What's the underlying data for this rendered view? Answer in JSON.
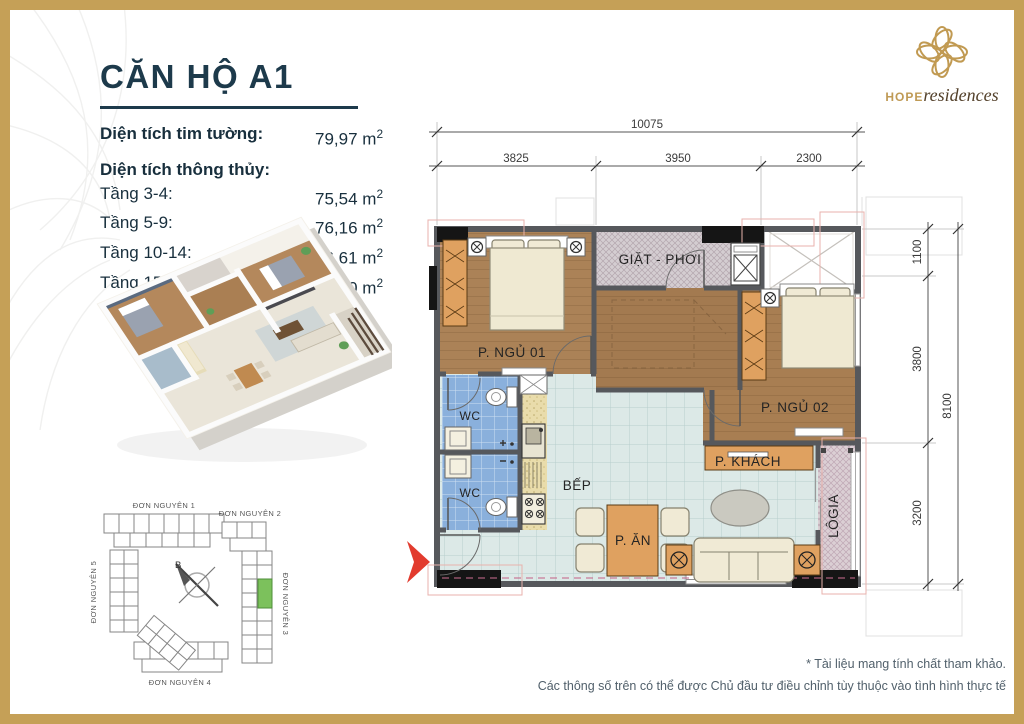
{
  "title": "CĂN HỘ A1",
  "areas": {
    "tim_tuong_label": "Diện tích tim tường:",
    "tim_tuong_value": "79,97",
    "thong_thuy_label": "Diện tích thông thủy:",
    "unit": "m",
    "unit_sup": "2",
    "rows": [
      {
        "label": "Tầng 3-4:",
        "value": "75,54"
      },
      {
        "label": "Tầng 5-9:",
        "value": "76,16"
      },
      {
        "label": "Tầng 10-14:",
        "value": "76,61"
      },
      {
        "label": "Tầng 15-20:",
        "value": "76,80"
      }
    ]
  },
  "logo": {
    "name": "hope",
    "suffix": "residences"
  },
  "floorplan": {
    "rooms": {
      "ngu01": "P. NGỦ 01",
      "giat_phoi": "GIẶT - PHƠI",
      "ngu02": "P. NGỦ 02",
      "wc": "WC",
      "bep": "BẾP",
      "khach": "P. KHÁCH",
      "an": "P. ĂN",
      "logia": "LÔGIA"
    },
    "dims_top": {
      "total": "10075",
      "segments": [
        "3825",
        "3950",
        "2300"
      ]
    },
    "dims_right": {
      "total": "8100",
      "segments": [
        "1100",
        "3800",
        "3200"
      ]
    }
  },
  "siteplan": {
    "labels": [
      "ĐƠN NGUYÊN 1",
      "ĐƠN NGUYÊN 2",
      "ĐƠN NGUYÊN 3",
      "ĐƠN NGUYÊN 4",
      "ĐƠN NGUYÊN 5"
    ],
    "compass": "B"
  },
  "footer": {
    "line1": "* Tài liệu mang tính chất tham khảo.",
    "line2": "Các thông số trên có thể được Chủ đầu tư điều chỉnh tùy thuộc vào tình hình thực tế"
  },
  "colors": {
    "gold": "#c5a057",
    "navy": "#1d3a4b",
    "arrow_red": "#e23b2e",
    "unit_green": "#7cc15c"
  }
}
